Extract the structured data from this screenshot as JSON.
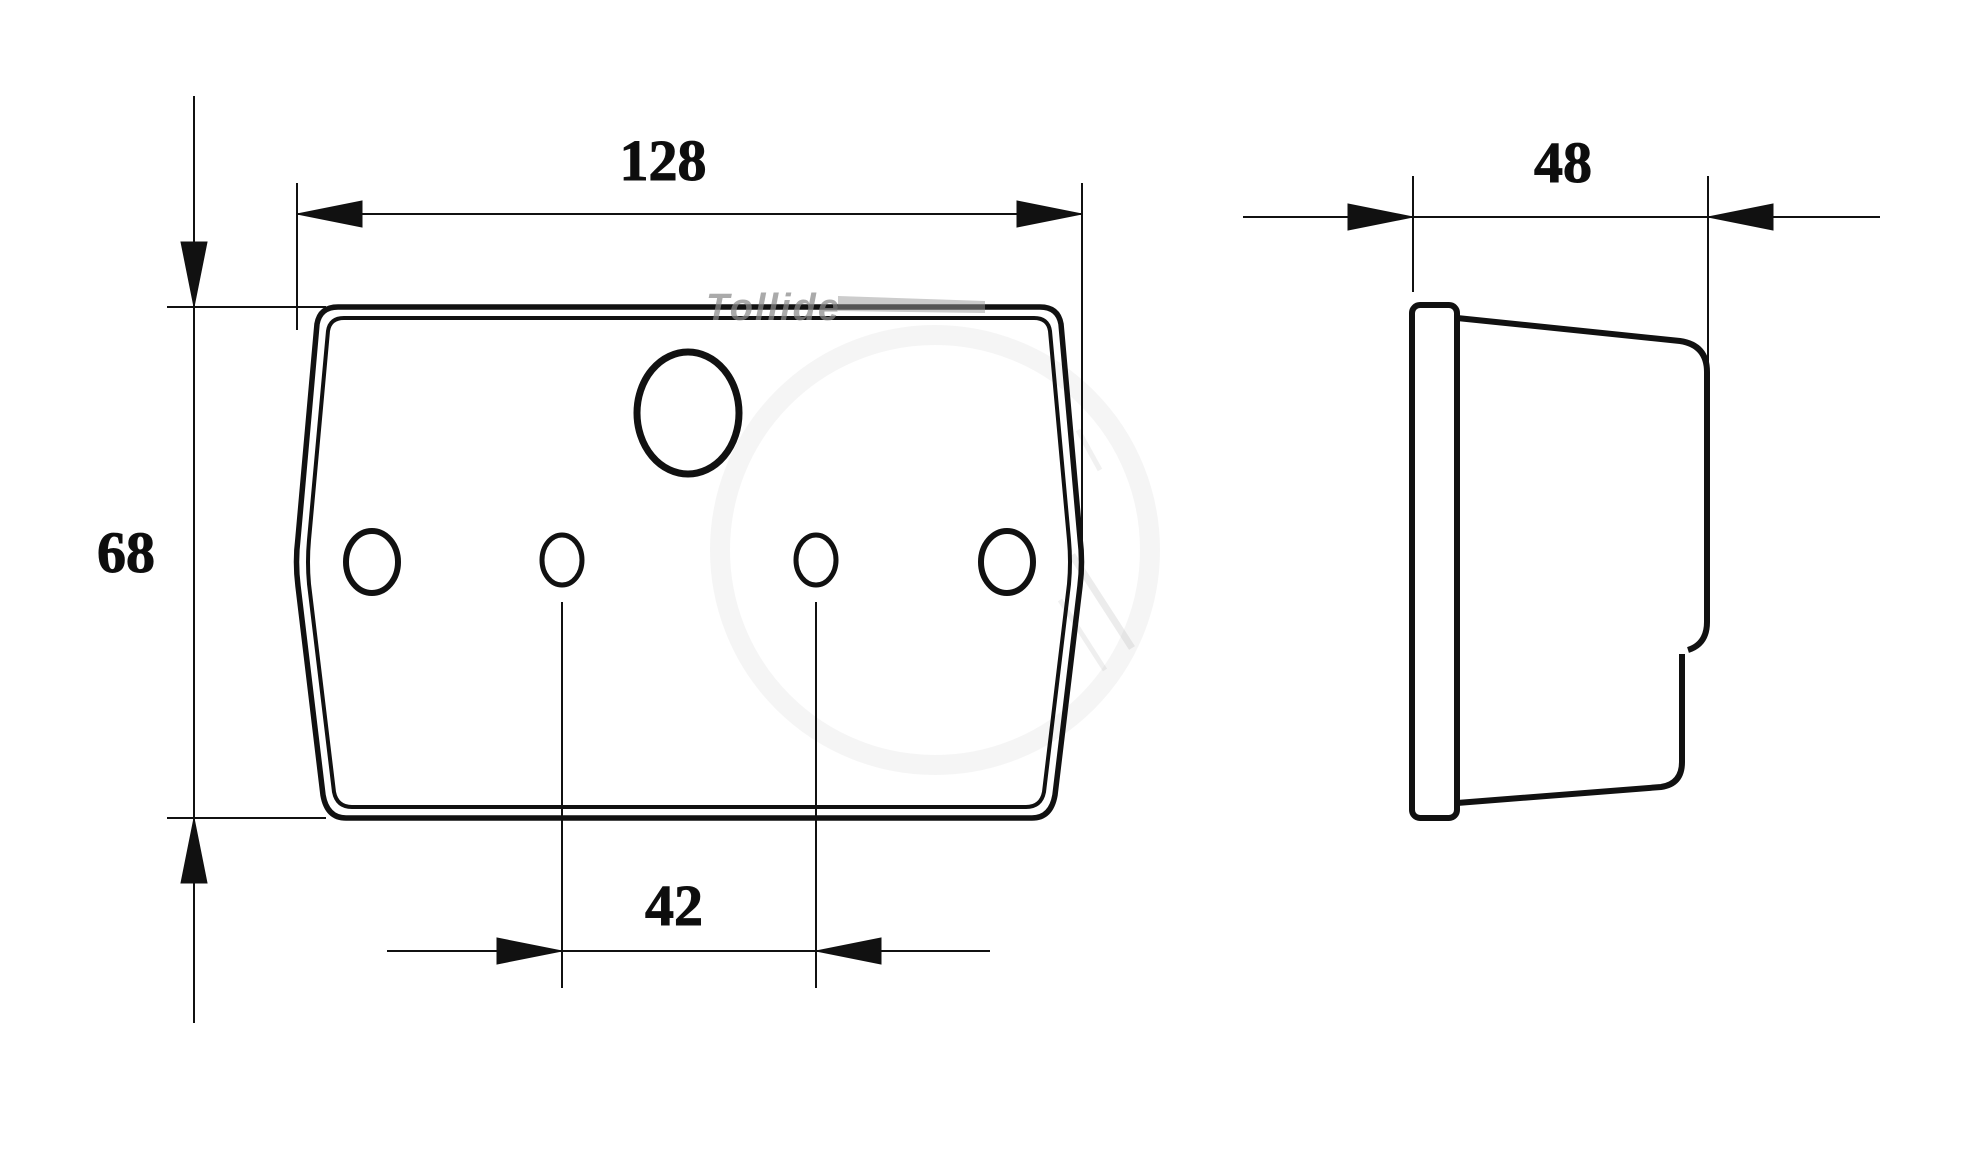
{
  "dimensions": {
    "front_width": "128",
    "front_height": "68",
    "hole_spacing": "42",
    "side_depth": "48"
  },
  "watermark": {
    "text": "Tollide"
  },
  "colors": {
    "line": "#111111",
    "background": "#ffffff",
    "watermark": "#8a8a8a"
  }
}
